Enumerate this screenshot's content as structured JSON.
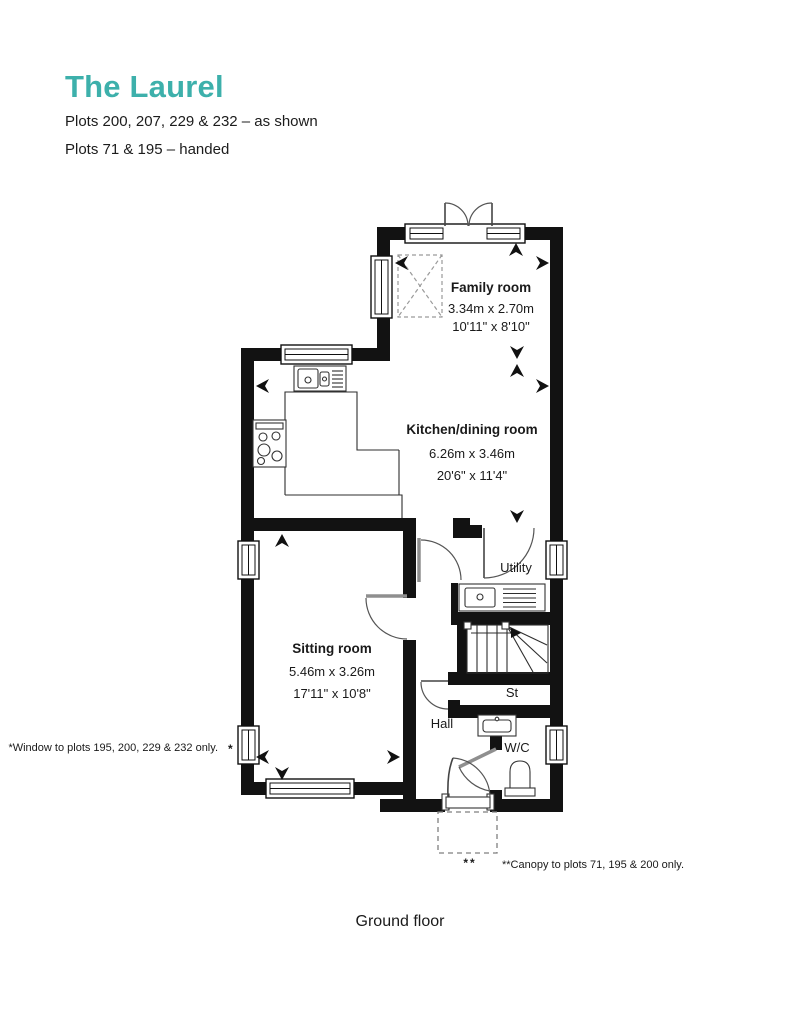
{
  "header": {
    "title": "The Laurel",
    "subtitle1": "Plots 200, 207, 229 & 232 – as shown",
    "subtitle2": "Plots 71 & 195 – handed"
  },
  "rooms": {
    "family": {
      "name": "Family room",
      "metric": "3.34m x 2.70m",
      "imperial": "10'11\" x 8'10\""
    },
    "kitchen": {
      "name": "Kitchen/dining room",
      "metric": "6.26m x 3.46m",
      "imperial": "20'6\" x 11'4\""
    },
    "sitting": {
      "name": "Sitting room",
      "metric": "5.46m x 3.26m",
      "imperial": "17'11\" x 10'8\""
    },
    "utility": {
      "name": "Utility"
    },
    "hall": {
      "name": "Hall"
    },
    "store": {
      "name": "St"
    },
    "wc": {
      "name": "W/C"
    }
  },
  "notes": {
    "window_marker": "*",
    "window_note": "*Window to plots 195, 200, 229 & 232 only.",
    "canopy_marker": "**",
    "canopy_note": "**Canopy to plots 71, 195 & 200 only."
  },
  "footer": {
    "caption": "Ground floor"
  },
  "colors": {
    "accent": "#3DB0AB",
    "wall": "#121212"
  }
}
